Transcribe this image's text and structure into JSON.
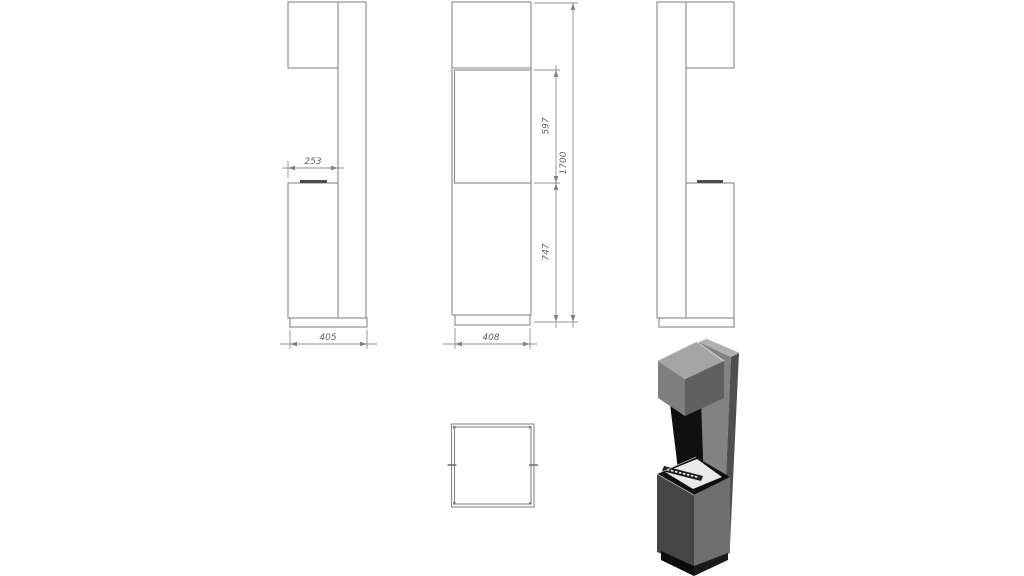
{
  "dimensions": {
    "dim_253": "253",
    "dim_405": "405",
    "dim_408": "408",
    "dim_597": "597",
    "dim_747": "747",
    "dim_1700": "1700"
  },
  "colors": {
    "background": "#ffffff",
    "object_line": "#85898d",
    "dimension_line": "#8d9195",
    "dimension_text": "#5d6165",
    "burner_lip": "#4b4e51",
    "iso": {
      "hood_top": "#a5a5a5",
      "hood_front": "#7f7f7f",
      "hood_right": "#606060",
      "column_top": "#b0b0b0",
      "column_front": "#828282",
      "column_right": "#4f4f4f",
      "niche": "#101010",
      "base_top_frame": "#0f0f0f",
      "deck": "#e9e9e9",
      "burner": "#1d1d1d",
      "base_front": "#454545",
      "base_right": "#6f6f6f",
      "plinth_front": "#0b0b0b",
      "plinth_right": "#1a1a1a"
    }
  }
}
